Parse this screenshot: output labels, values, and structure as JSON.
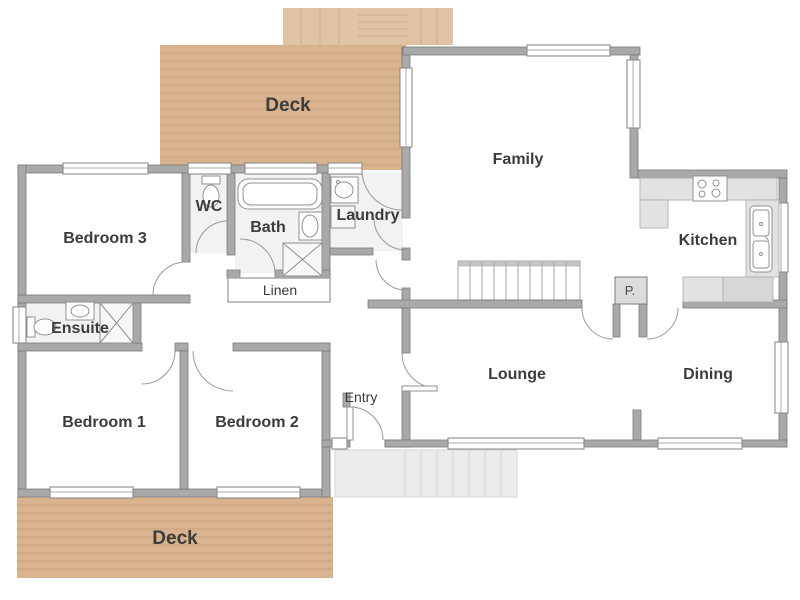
{
  "figure": {
    "type": "floor-plan"
  },
  "colors": {
    "wall": "#a9a9a9",
    "wallStroke": "#7a7a7a",
    "deck": "#d8b38e",
    "deckLine": "#c9a37c",
    "deckSteps": "#dfc3a4",
    "deckLine2": "#cfae8c",
    "wetRoom": "#f2f2f2",
    "counter": "#e2e2e2",
    "counterDark": "#d7d7d7",
    "counterStroke": "#aaaaaa",
    "porch": "#ebedeb",
    "porchLine": "#d6d6d6",
    "stairStroke": "#a5a5a5",
    "winStroke": "#8c8c8c",
    "fixStroke": "#909090",
    "doorStroke": "#9a9a9a",
    "label": "#3c3c3c"
  },
  "rooms": {
    "deck_top": {
      "label": "Deck"
    },
    "bedroom3": {
      "label": "Bedroom 3"
    },
    "wc": {
      "label": "WC"
    },
    "bath": {
      "label": "Bath"
    },
    "laundry": {
      "label": "Laundry"
    },
    "family": {
      "label": "Family"
    },
    "kitchen": {
      "label": "Kitchen"
    },
    "linen": {
      "label": "Linen"
    },
    "ensuite": {
      "label": "Ensuite"
    },
    "pantry": {
      "label": "P."
    },
    "bedroom1": {
      "label": "Bedroom 1"
    },
    "bedroom2": {
      "label": "Bedroom 2"
    },
    "entry": {
      "label": "Entry"
    },
    "lounge": {
      "label": "Lounge"
    },
    "dining": {
      "label": "Dining"
    },
    "deck_bottom": {
      "label": "Deck"
    }
  },
  "fixtures": {
    "toilet": "toilet",
    "bathtub": "bathtub",
    "shower": "shower",
    "vanity_basin": "vanity-basin",
    "laundry_tub": "laundry-tub",
    "washing_machine": "washing-machine",
    "cooktop": "cooktop",
    "double_sink": "double-sink",
    "stairs": "stairs"
  }
}
